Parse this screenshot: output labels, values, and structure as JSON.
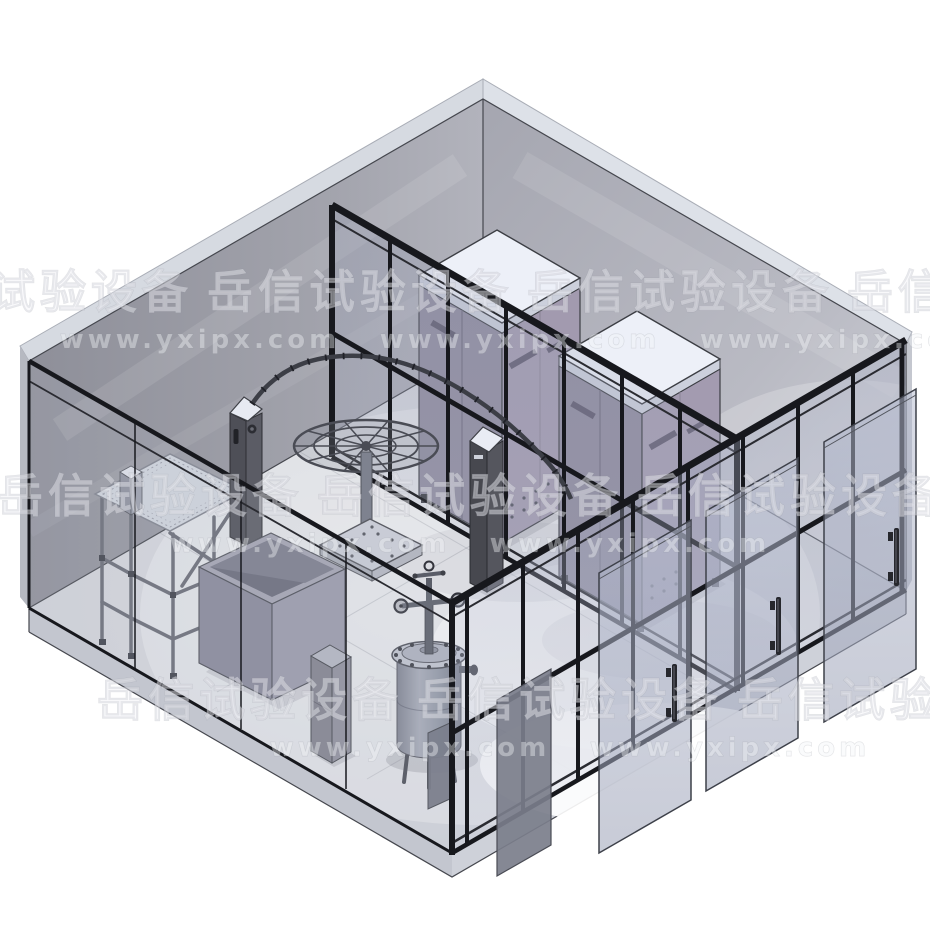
{
  "scene": {
    "type": "isometric-3d-cad-render",
    "watermark": {
      "brand_cn": "岳信试验设备",
      "brand_url": "www.yxipx.com"
    },
    "colors": {
      "background": "#ffffff",
      "wall_left": "#90919b",
      "wall_right": "#abacb5",
      "floor": "#ced0d7",
      "roof_edge": "#d8dbe2",
      "frame_black": "#17181d",
      "glass_tint": "#aab0c4",
      "chamber_body": "#8e8a9d",
      "chamber_top": "#eef1f8",
      "equipment_gray": "#8d919f",
      "dark_pillar": "#515259"
    },
    "equipment": [
      "drip-test-stand",
      "open-test-box",
      "storage-cabinet",
      "immersion-pressure-tank",
      "oscillating-tube-rig",
      "spray-turntable",
      "control-pillar-left",
      "control-pillar-center",
      "walk-in-test-chamber-1",
      "walk-in-test-chamber-2",
      "mid-cabinet",
      "glass-partition-wall",
      "glass-front-walls",
      "sliding-glass-doors"
    ]
  }
}
